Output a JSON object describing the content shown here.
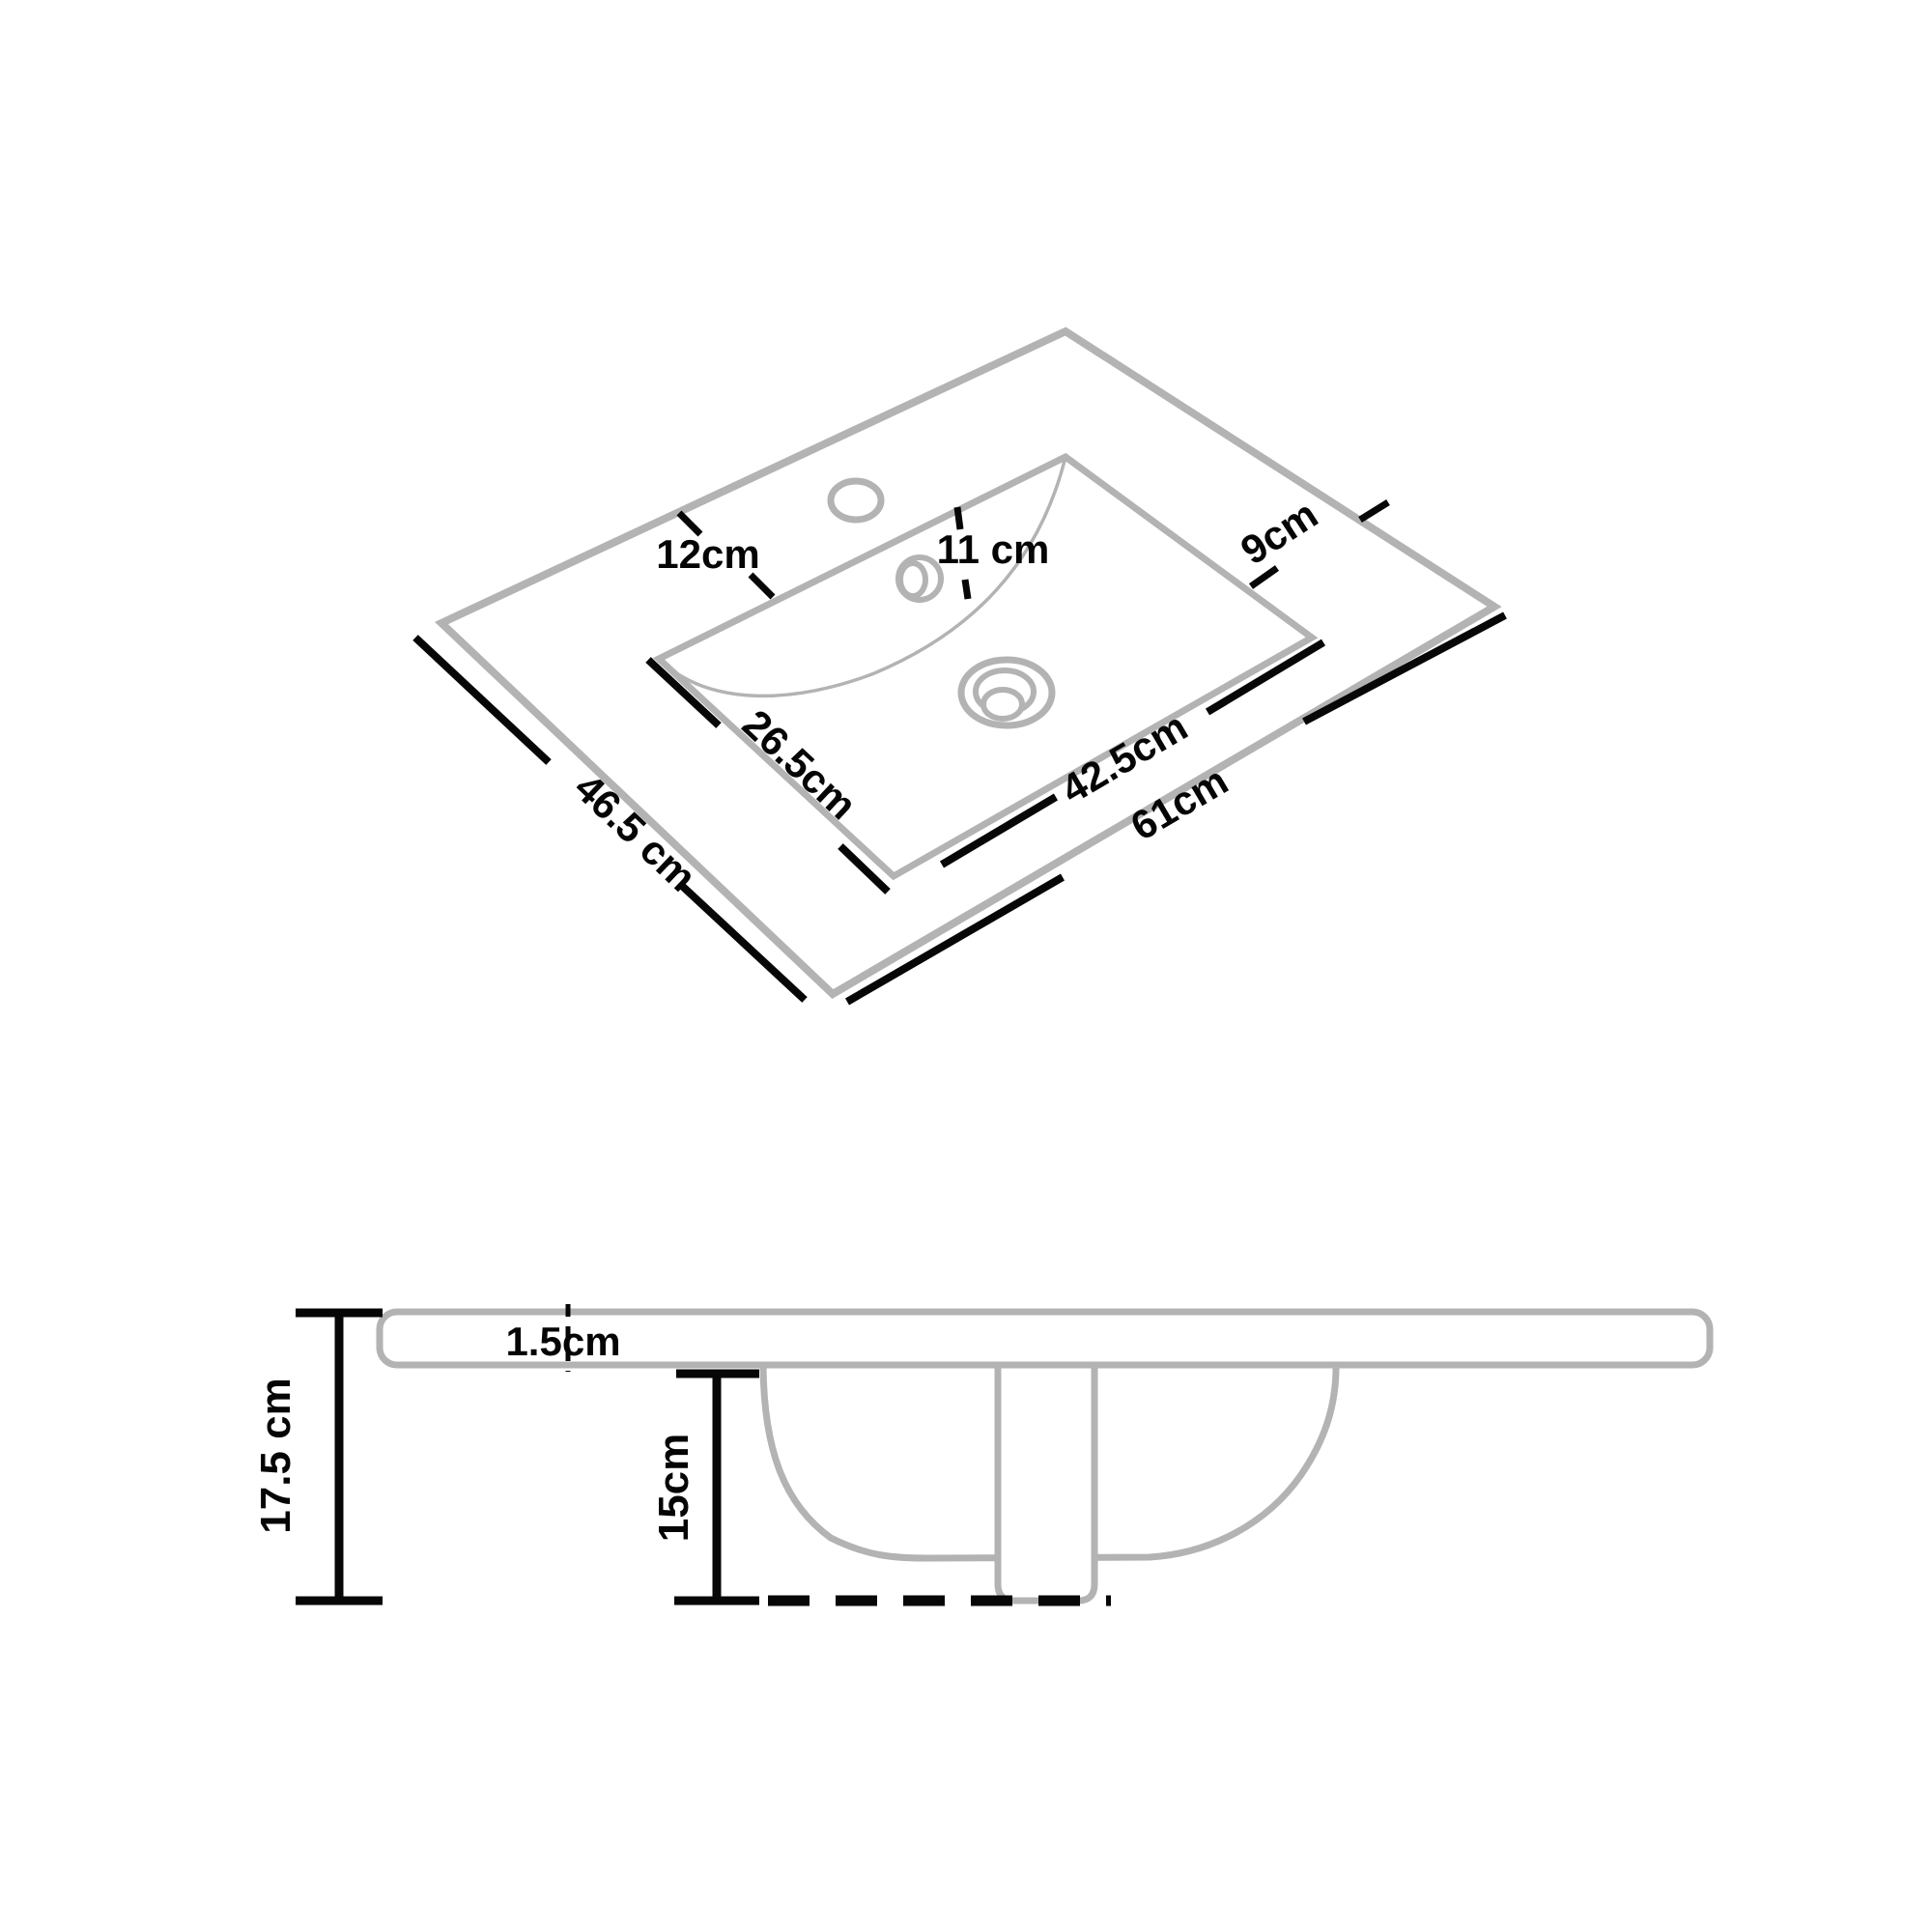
{
  "drawing": {
    "type": "sink-dimension-diagram",
    "views": [
      "top-isometric",
      "side-section"
    ]
  },
  "top_view": {
    "dim_faucet_offset": "12cm",
    "dim_ledge": "11 cm",
    "dim_back_ledge": "9cm",
    "dim_basin_depth": "26.5cm",
    "dim_basin_width": "42.5cm",
    "dim_total_width": "61cm",
    "dim_total_depth": "46.5 cm"
  },
  "side_view": {
    "dim_slab_thickness": "1.5cm",
    "dim_total_height": "17.5 cm",
    "dim_bowl_depth": "15cm"
  },
  "colors": {
    "outline_gray": "#b3b3b3",
    "dimension_black": "#070707",
    "background": "#ffffff"
  }
}
